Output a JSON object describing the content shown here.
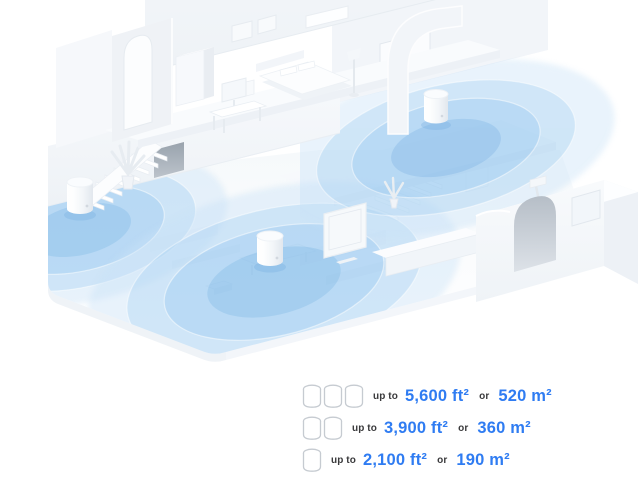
{
  "colors": {
    "accent_blue": "#2F7CF2",
    "text_dark": "#3A3A3C",
    "coverage_blue_core": "#81B8E8",
    "coverage_blue_outer": "#C7E1F7",
    "icon_outline": "#C6CBD1"
  },
  "illustration": {
    "name": "mesh-wifi-home-coverage",
    "units": [
      "wifi-unit-left-room",
      "wifi-unit-upper-landing",
      "wifi-unit-living-room"
    ]
  },
  "legend": {
    "rows": [
      {
        "unit_count": 3,
        "prefix": "up to",
        "imperial": "5,600 ft²",
        "conjunction": "or",
        "metric": "520 m²"
      },
      {
        "unit_count": 2,
        "prefix": "up to",
        "imperial": "3,900 ft²",
        "conjunction": "or",
        "metric": "360 m²"
      },
      {
        "unit_count": 1,
        "prefix": "up to",
        "imperial": "2,100 ft²",
        "conjunction": "or",
        "metric": "190 m²"
      }
    ]
  }
}
